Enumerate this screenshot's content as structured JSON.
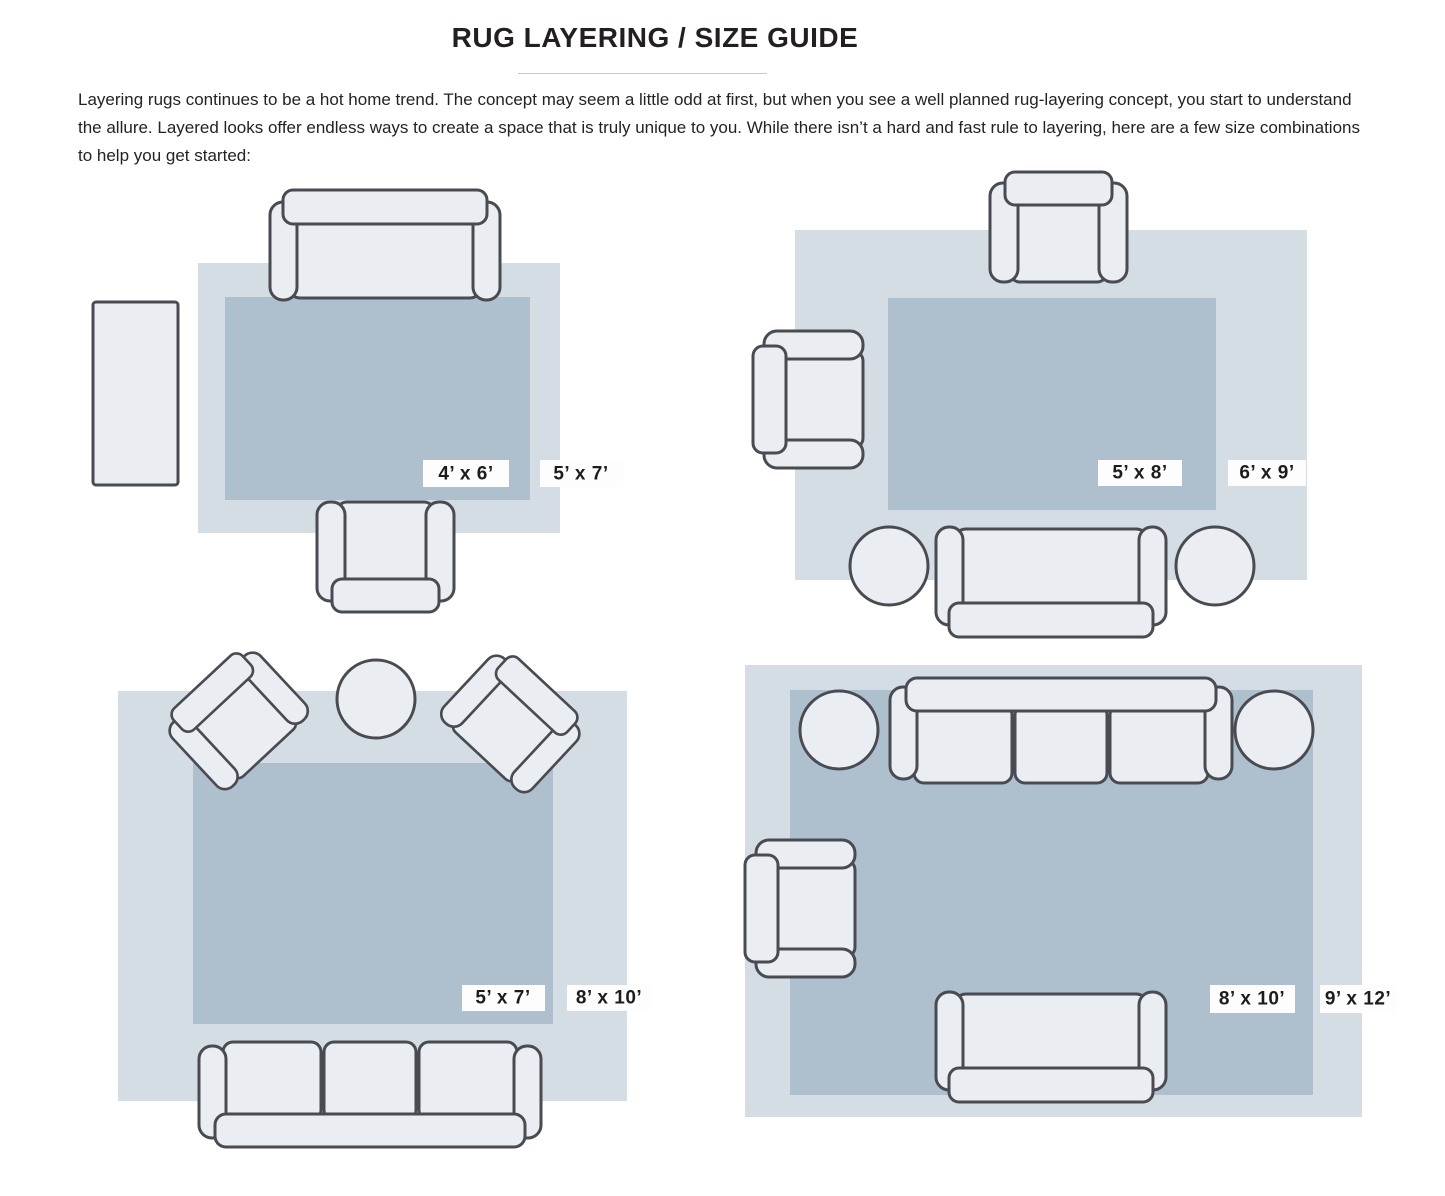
{
  "title": "RUG LAYERING / SIZE GUIDE",
  "intro": "Layering rugs continues to be a hot home trend. The concept may seem a little odd at first, but when you see a well planned rug-layering concept, you start to understand the allure. Layered looks offer endless ways to create a space that is truly unique to you. While there isn’t a hard and fast rule to layering, here are a few size combinations to help you get started:",
  "palette": {
    "page-bg": "#ffffff",
    "outer-rug": "#d4dce4",
    "inner-rug": "#aec0ce",
    "furniture-fill": "#eaeef3",
    "furniture-stroke": "#4a4b52",
    "label-bg": "#fdfdfd",
    "label-text": "#1c1c1e",
    "title-color": "#231f20",
    "body-color": "#232323",
    "divider-color": "#c8c8c8"
  },
  "diagrams": [
    {
      "id": "top-left",
      "inner_label": "4’ x 6’",
      "outer_label": "5’ x 7’"
    },
    {
      "id": "top-right",
      "inner_label": "5’ x 8’",
      "outer_label": "6’ x 9’"
    },
    {
      "id": "bottom-left",
      "inner_label": "5’ x 7’",
      "outer_label": "8’ x 10’"
    },
    {
      "id": "bottom-right",
      "inner_label": "8’ x 10’",
      "outer_label": "9’ x 12’"
    }
  ]
}
